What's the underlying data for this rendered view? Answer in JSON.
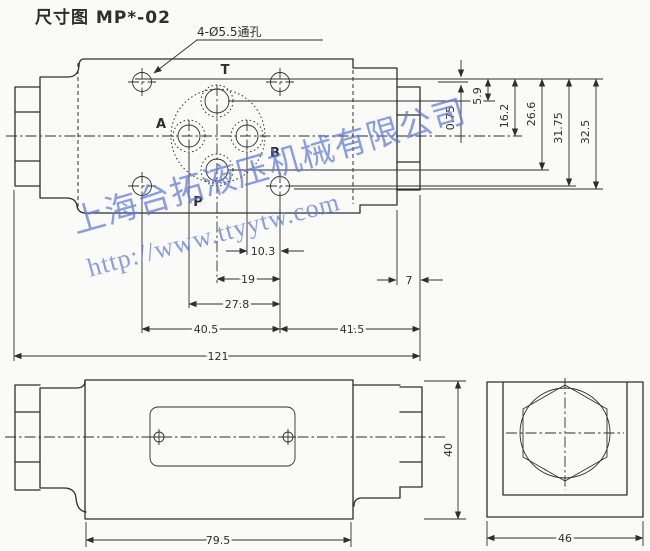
{
  "title": "尺寸图 MP*-02",
  "callout_label": "4-Ø5.5通孔",
  "port_labels": {
    "t": "T",
    "a": "A",
    "b": "B",
    "p": "P"
  },
  "dims": {
    "v_bolt_top": "0.75",
    "v_t_port": "5.9",
    "v_ab_ports": "16.2",
    "v_p_port": "26.6",
    "v_bolt_bottom": "31.75",
    "v_pattern_bottom": "32.5",
    "h_b_to_bolt": "10.3",
    "h_p_to_bolt": "19",
    "h_a_to_bolt": "27.8",
    "h_bolt_span": "40.5",
    "h_bolt_to_right": "41.5",
    "h_total_length": "121",
    "h_end_plug": "7",
    "side_body_length": "79.5",
    "side_body_height": "40",
    "end_view_width": "46"
  },
  "watermark": {
    "company": "上海台拓液压机械有限公司",
    "url": "http://www.ttyytw.com"
  },
  "colors": {
    "line": "#2e2e2e",
    "background": "#fafaf8",
    "watermark": "#5d79dd"
  }
}
